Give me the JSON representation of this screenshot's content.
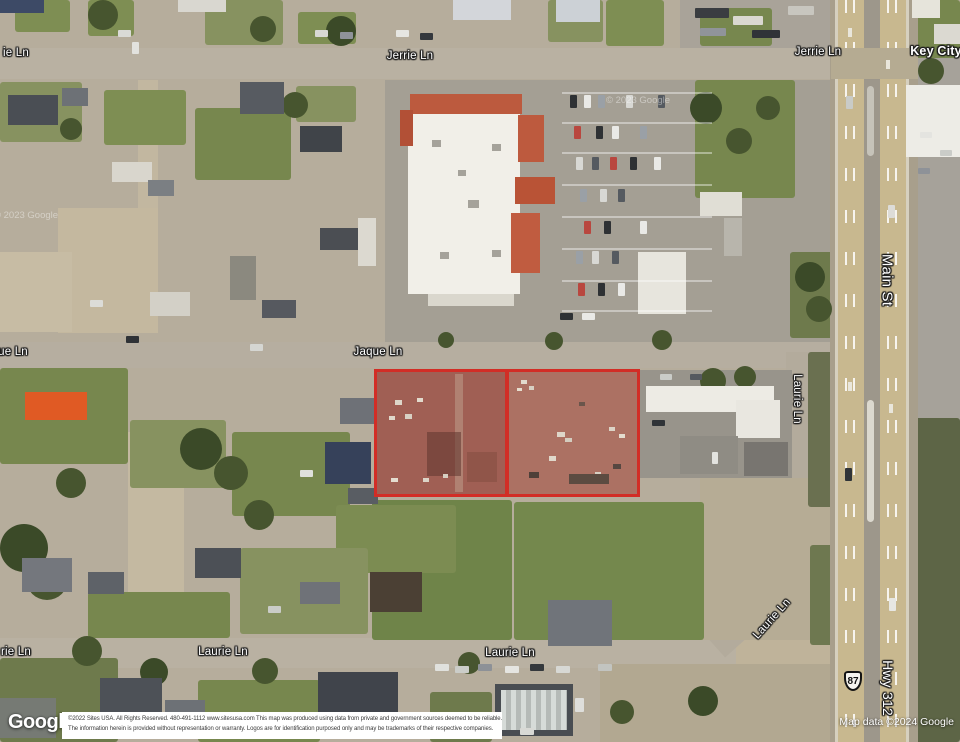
{
  "map_labels": {
    "jerrie_ln_left_partial": "ie Ln",
    "jerrie_ln_center": "Jerrie Ln",
    "jerrie_ln_right": "Jerrie Ln",
    "key_city": "Key City",
    "main_st": "Main St",
    "jaque_ln_left_partial": "ue Ln",
    "jaque_ln": "Jaque Ln",
    "laurie_ln_upper_vertical": "Laurie Ln",
    "laurie_ln_diagonal": "Laurie Ln",
    "laurie_ln_left_partial": "rie Ln",
    "laurie_ln_center": "Laurie Ln",
    "laurie_ln_right": "Laurie Ln",
    "hwy_312": "Hwy 312",
    "route_shield_87": "87"
  },
  "highlighted_parcel": {
    "parcel_count": 2,
    "outline_color": "#d22d26"
  },
  "watermark": "© 2023 Google",
  "attribution": {
    "google_logo": "Google",
    "line1": "©2022 Sites USA.  All Rights Reserved.  480-491-1112   www.sitesusa.com   This map was produced using data from private and government sources deemed to be reliable.",
    "line2": "The information herein is provided without representation or warranty.   Logos are for identification purposed only and may be trademarks of their respective companies.",
    "map_data": "Map data ©2024 Google"
  }
}
